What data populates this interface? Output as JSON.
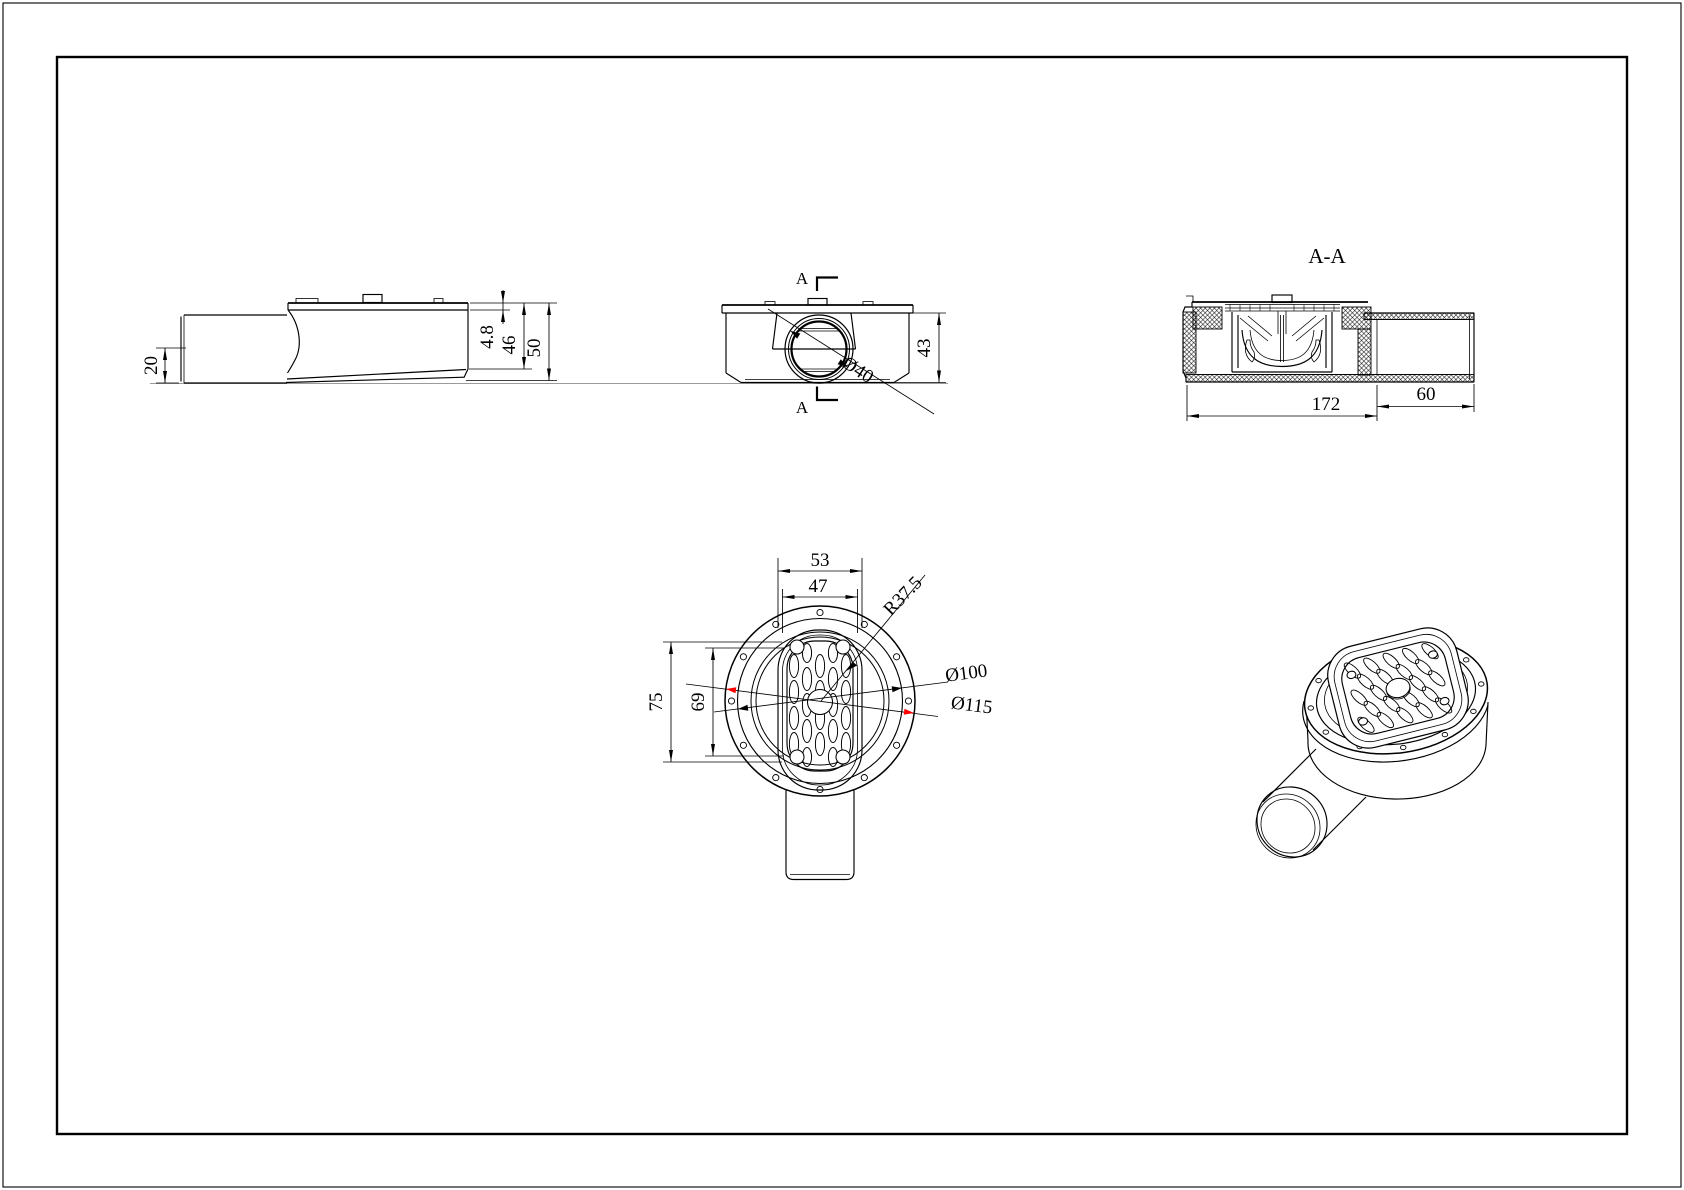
{
  "drawing": {
    "side_view": {
      "h20": "20",
      "h48": "4.8",
      "h46": "46",
      "h50": "50"
    },
    "front_view": {
      "a_top": "A",
      "a_bottom": "A",
      "h43": "43",
      "dia40": "Ø40"
    },
    "section_view": {
      "title": "A-A",
      "len172": "172",
      "len60": "60"
    },
    "plan_view": {
      "w53": "53",
      "w47": "47",
      "r375": "R37.5",
      "h75": "75",
      "h69": "69",
      "dia100": "Ø100",
      "dia115": "Ø115"
    },
    "colors": {
      "highlight": "#ff0000",
      "line": "#000000"
    }
  }
}
